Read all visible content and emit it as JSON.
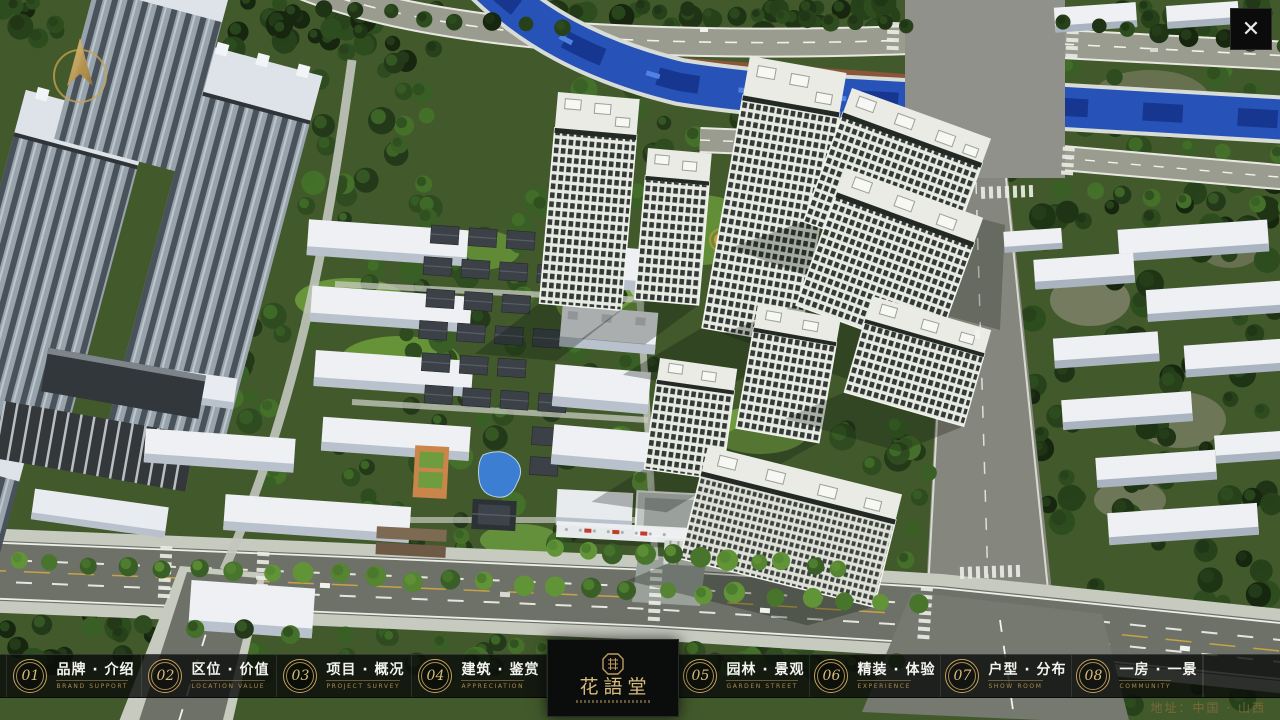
{
  "viewport": {
    "close_glyph": "✕"
  },
  "menu": {
    "items": [
      {
        "num": "01",
        "zh": "品牌 · 介绍",
        "en": "BRAND SUPPORT"
      },
      {
        "num": "02",
        "zh": "区位 · 价值",
        "en": "LOCATION VALUE"
      },
      {
        "num": "03",
        "zh": "项目 · 概况",
        "en": "PROJECT SURVEY"
      },
      {
        "num": "04",
        "zh": "建筑 · 鉴赏",
        "en": "APPRECIATION"
      },
      {
        "num": "05",
        "zh": "园林 · 景观",
        "en": "GARDEN STREET"
      },
      {
        "num": "06",
        "zh": "精装 · 体验",
        "en": "EXPERIENCE"
      },
      {
        "num": "07",
        "zh": "户型 · 分布",
        "en": "SHOW ROOM"
      },
      {
        "num": "08",
        "zh": "一房 · 一景",
        "en": "COMMUNITY"
      }
    ],
    "logo": {
      "title": "花語堂"
    },
    "address": "地址：中国 · 山西"
  }
}
